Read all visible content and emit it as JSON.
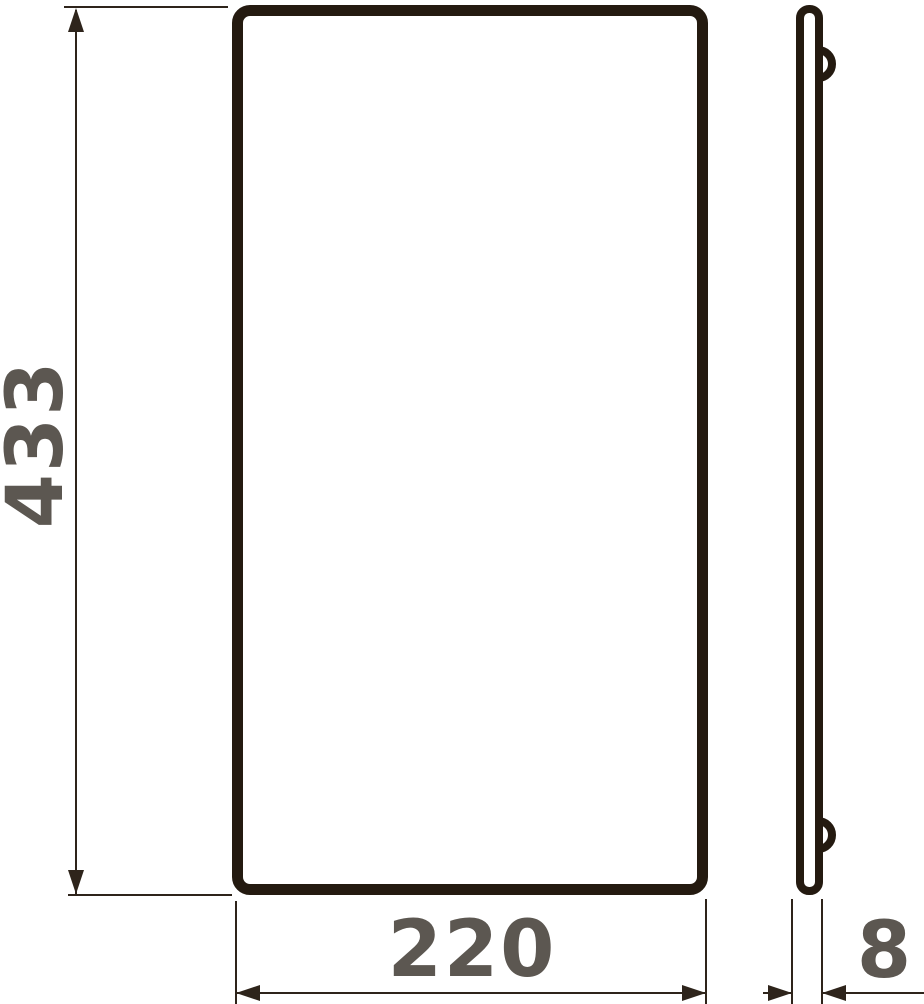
{
  "drawing": {
    "kind": "technical-dimension-drawing",
    "front_view": {
      "height_label": "433",
      "width_label": "220"
    },
    "side_view": {
      "thickness_label": "8"
    },
    "colors": {
      "outline": "#241a10",
      "dimension_line": "#2e241b",
      "label_text": "#5c5751",
      "background": "#ffffff"
    }
  }
}
